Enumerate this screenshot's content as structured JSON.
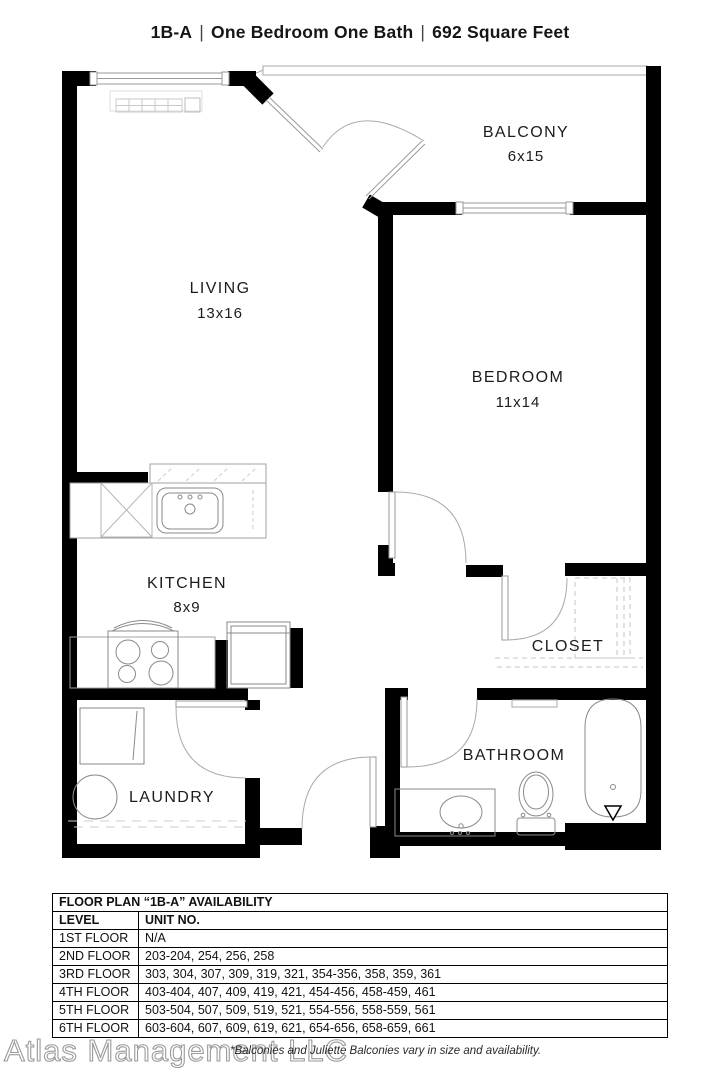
{
  "title": {
    "unit": "1B-A",
    "sep": "|",
    "type": "One Bedroom One Bath",
    "area": "692 Square Feet"
  },
  "plan": {
    "rooms": {
      "living": {
        "name": "LIVING",
        "dims": "13x16"
      },
      "balcony": {
        "name": "BALCONY",
        "dims": "6x15"
      },
      "bedroom": {
        "name": "BEDROOM",
        "dims": "11x14"
      },
      "kitchen": {
        "name": "KITCHEN",
        "dims": "8x9"
      },
      "closet": {
        "name": "CLOSET"
      },
      "bathroom": {
        "name": "BATHROOM"
      },
      "laundry": {
        "name": "LAUNDRY"
      }
    }
  },
  "availability": {
    "title": "FLOOR PLAN “1B-A” AVAILABILITY",
    "columns": {
      "level": "LEVEL",
      "units": "UNIT NO."
    },
    "rows": [
      {
        "level": "1ST FLOOR",
        "units": "N/A"
      },
      {
        "level": "2ND FLOOR",
        "units": "203-204, 254, 256, 258"
      },
      {
        "level": "3RD FLOOR",
        "units": "303, 304, 307, 309, 319, 321, 354-356, 358, 359, 361"
      },
      {
        "level": "4TH FLOOR",
        "units": "403-404, 407, 409, 419, 421, 454-456, 458-459, 461"
      },
      {
        "level": "5TH FLOOR",
        "units": "503-504, 507, 509, 519, 521, 554-556, 558-559, 561"
      },
      {
        "level": "6TH FLOOR",
        "units": "603-604, 607, 609, 619, 621, 654-656, 658-659, 661"
      }
    ]
  },
  "footer": {
    "watermark": "Atlas Management LLC",
    "note": "*Balconies and Juliette Balconies vary in size and availability."
  },
  "colors": {
    "wall": "#000000",
    "fixture": "#8a8a8a",
    "thin_line": "#9a9a9a",
    "dash": "#c4c4c4"
  }
}
